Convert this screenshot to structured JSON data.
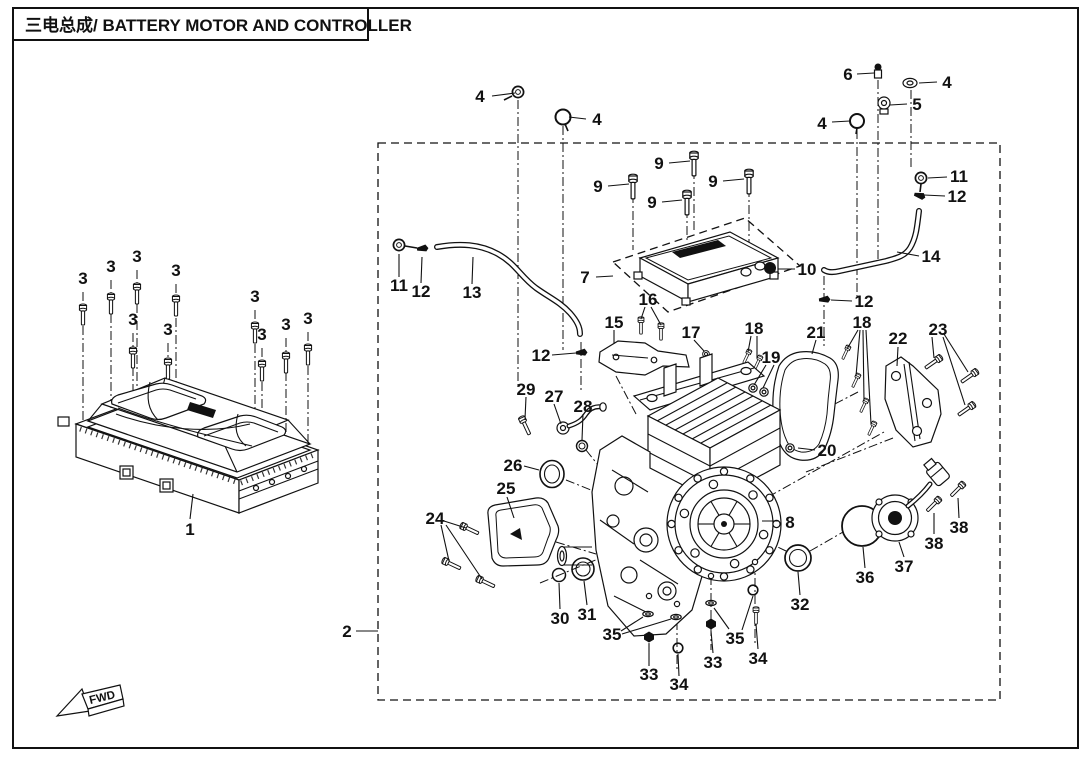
{
  "title": "三电总成/ BATTERY MOTOR AND CONTROLLER",
  "direction_marker": "FWD",
  "colors": {
    "ink": "#111111",
    "background": "#ffffff"
  },
  "callouts": [
    {
      "part": "3",
      "x": 83,
      "y": 284
    },
    {
      "part": "3",
      "x": 111,
      "y": 272
    },
    {
      "part": "3",
      "x": 137,
      "y": 262
    },
    {
      "part": "3",
      "x": 176,
      "y": 276
    },
    {
      "part": "3",
      "x": 133,
      "y": 325
    },
    {
      "part": "3",
      "x": 168,
      "y": 335
    },
    {
      "part": "3",
      "x": 255,
      "y": 302
    },
    {
      "part": "3",
      "x": 262,
      "y": 340
    },
    {
      "part": "3",
      "x": 286,
      "y": 330
    },
    {
      "part": "3",
      "x": 308,
      "y": 324
    },
    {
      "part": "1",
      "x": 190,
      "y": 535
    },
    {
      "part": "2",
      "x": 347,
      "y": 637
    },
    {
      "part": "4",
      "x": 480,
      "y": 102
    },
    {
      "part": "4",
      "x": 597,
      "y": 125
    },
    {
      "part": "6",
      "x": 848,
      "y": 80
    },
    {
      "part": "4",
      "x": 947,
      "y": 88
    },
    {
      "part": "5",
      "x": 917,
      "y": 110
    },
    {
      "part": "4",
      "x": 822,
      "y": 129
    },
    {
      "part": "11",
      "x": 959,
      "y": 182
    },
    {
      "part": "12",
      "x": 957,
      "y": 202
    },
    {
      "part": "14",
      "x": 931,
      "y": 262
    },
    {
      "part": "9",
      "x": 598,
      "y": 192
    },
    {
      "part": "9",
      "x": 659,
      "y": 169
    },
    {
      "part": "9",
      "x": 713,
      "y": 187
    },
    {
      "part": "9",
      "x": 652,
      "y": 208
    },
    {
      "part": "7",
      "x": 585,
      "y": 283
    },
    {
      "part": "10",
      "x": 807,
      "y": 275
    },
    {
      "part": "11",
      "x": 399,
      "y": 291
    },
    {
      "part": "12",
      "x": 421,
      "y": 297
    },
    {
      "part": "13",
      "x": 472,
      "y": 298
    },
    {
      "part": "12",
      "x": 541,
      "y": 361
    },
    {
      "part": "12",
      "x": 864,
      "y": 307
    },
    {
      "part": "15",
      "x": 614,
      "y": 328
    },
    {
      "part": "16",
      "x": 648,
      "y": 305
    },
    {
      "part": "17",
      "x": 691,
      "y": 338
    },
    {
      "part": "18",
      "x": 754,
      "y": 334
    },
    {
      "part": "19",
      "x": 771,
      "y": 363
    },
    {
      "part": "21",
      "x": 816,
      "y": 338
    },
    {
      "part": "18",
      "x": 862,
      "y": 328
    },
    {
      "part": "22",
      "x": 898,
      "y": 344
    },
    {
      "part": "23",
      "x": 938,
      "y": 335
    },
    {
      "part": "20",
      "x": 827,
      "y": 456
    },
    {
      "part": "29",
      "x": 526,
      "y": 395
    },
    {
      "part": "27",
      "x": 554,
      "y": 402
    },
    {
      "part": "28",
      "x": 583,
      "y": 412
    },
    {
      "part": "26",
      "x": 513,
      "y": 471
    },
    {
      "part": "25",
      "x": 506,
      "y": 494
    },
    {
      "part": "24",
      "x": 435,
      "y": 524
    },
    {
      "part": "30",
      "x": 560,
      "y": 624
    },
    {
      "part": "31",
      "x": 587,
      "y": 620
    },
    {
      "part": "35",
      "x": 612,
      "y": 640
    },
    {
      "part": "33",
      "x": 649,
      "y": 680
    },
    {
      "part": "34",
      "x": 679,
      "y": 690
    },
    {
      "part": "35",
      "x": 735,
      "y": 644
    },
    {
      "part": "33",
      "x": 713,
      "y": 668
    },
    {
      "part": "34",
      "x": 758,
      "y": 664
    },
    {
      "part": "8",
      "x": 790,
      "y": 528
    },
    {
      "part": "32",
      "x": 800,
      "y": 610
    },
    {
      "part": "36",
      "x": 865,
      "y": 583
    },
    {
      "part": "37",
      "x": 904,
      "y": 572
    },
    {
      "part": "38",
      "x": 934,
      "y": 549
    },
    {
      "part": "38",
      "x": 959,
      "y": 533
    }
  ]
}
